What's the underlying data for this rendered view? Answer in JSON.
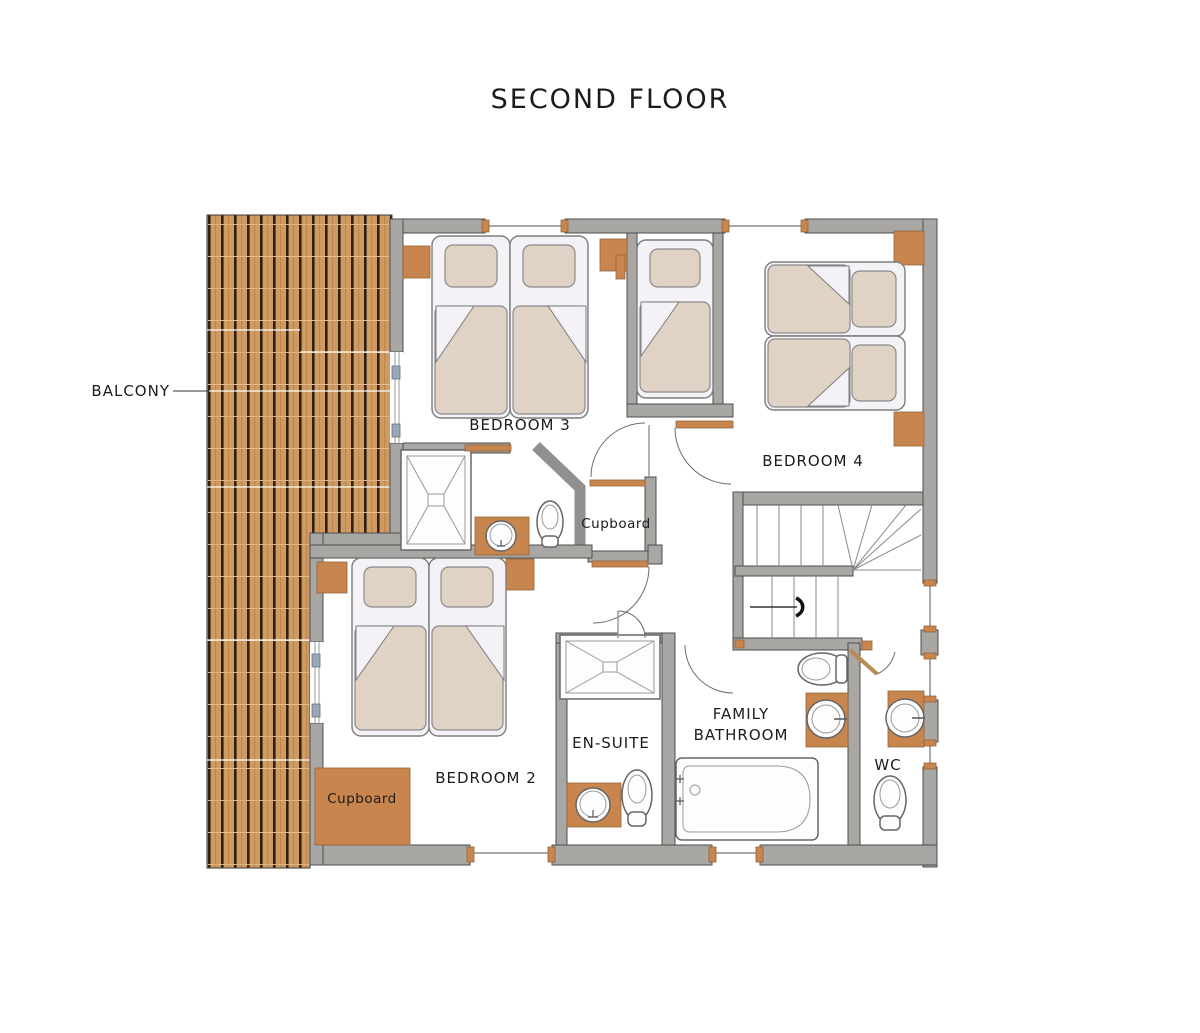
{
  "title": "SECOND FLOOR",
  "labels": {
    "balcony": "BALCONY",
    "bedroom3": "BEDROOM 3",
    "bedroom4": "BEDROOM 4",
    "bedroom2": "BEDROOM 2",
    "cupboard_upper": "Cupboard",
    "cupboard_lower": "Cupboard",
    "ensuite": "EN-SUITE",
    "family_bathroom_line1": "FAMILY",
    "family_bathroom_line2": "BATHROOM",
    "wc": "WC"
  },
  "colors": {
    "wall": "#a9a7a4",
    "wall_outline": "#4c4c4c",
    "deck_wood": "#cf9b61",
    "deck_stripe": "#30200f",
    "accent_wood": "#c8854e",
    "bedding": "#e0d2c4",
    "linen": "#f4f2f6",
    "text": "#1b1b1b"
  },
  "fixtures": {
    "showers": 2,
    "toilets": 4,
    "basins": 4,
    "baths": 1,
    "staircase": 1,
    "balcony_doors": 2
  }
}
